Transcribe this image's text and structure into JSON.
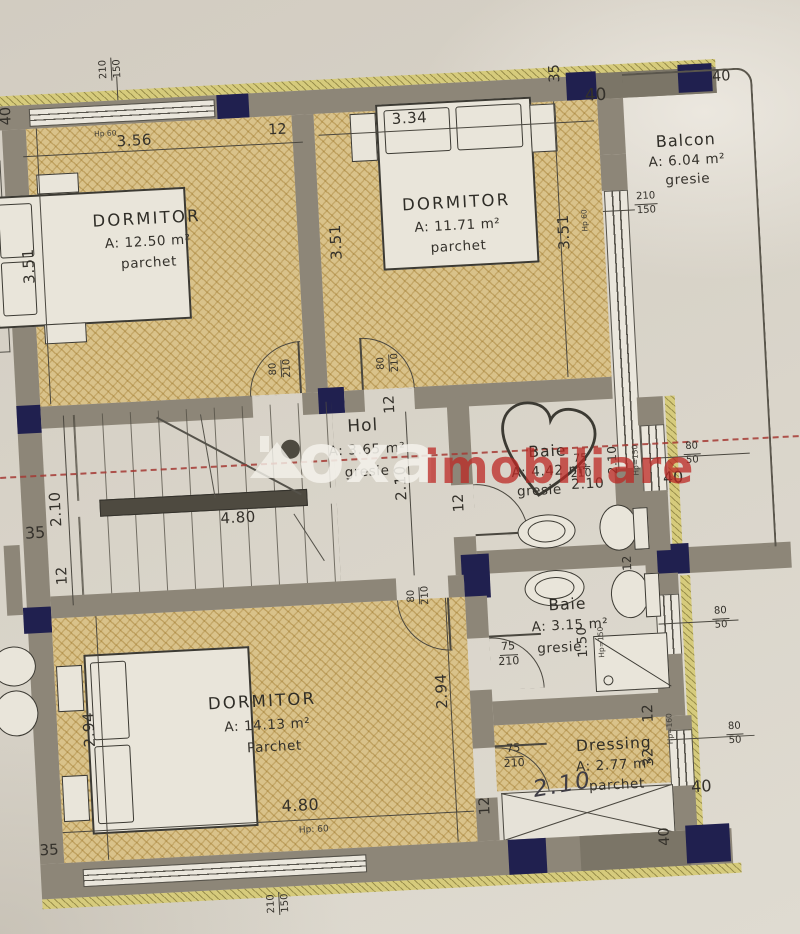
{
  "watermark": {
    "brand": "oxa",
    "word": "imobiliare"
  },
  "rooms": {
    "dormitor1": {
      "name": "DORMITOR",
      "area": "A: 12.50 m²",
      "floor": "parchet"
    },
    "dormitor2": {
      "name": "DORMITOR",
      "area": "A: 11.71 m²",
      "floor": "parchet"
    },
    "balcon": {
      "name": "Balcon",
      "area": "A: 6.04 m²",
      "floor": "gresie"
    },
    "hol": {
      "name": "Hol",
      "area": "A: 3.65 m²",
      "floor": "gresie"
    },
    "baie1": {
      "name": "Baie",
      "area": "A: 4.42 m²",
      "floor": "gresie"
    },
    "baie2": {
      "name": "Baie",
      "area": "A: 3.15 m²",
      "floor": "gresie"
    },
    "dormitor3": {
      "name": "DORMITOR",
      "area": "A: 14.13 m²",
      "floor": "Parchet"
    },
    "dressing": {
      "name": "Dressing",
      "area": "A: 2.77 m²",
      "floor": "parchet"
    }
  },
  "dims": {
    "d356": "3.56",
    "d334": "3.34",
    "d351": "3.51",
    "d210": "2.10",
    "d480": "4.80",
    "d294": "2.94",
    "d150": "1.50",
    "note210": "2.10"
  },
  "openings": {
    "door80": {
      "w": "80",
      "h": "210"
    },
    "door75": {
      "w": "75",
      "h": "210"
    },
    "window_lg": {
      "w": "210",
      "h": "150"
    },
    "window_sm": {
      "w": "80",
      "h": "50"
    }
  },
  "markers": {
    "m12": "12",
    "m32": "32",
    "m35": "35",
    "m40": "40"
  },
  "hp": {
    "hp60": "Hp: 60",
    "hp60b": "Hp 60",
    "hp150": "Hp=150",
    "hp160": "Hp=160"
  },
  "colors": {
    "paper": "#d9d4ca",
    "wall": "#8d8678",
    "column": "#20204f",
    "parquet": "#d9c28a",
    "insulation": "#d6cb7c",
    "section_line": "#a84038",
    "watermark_red": "#bc2824",
    "watermark_white": "#f3f0e9"
  }
}
